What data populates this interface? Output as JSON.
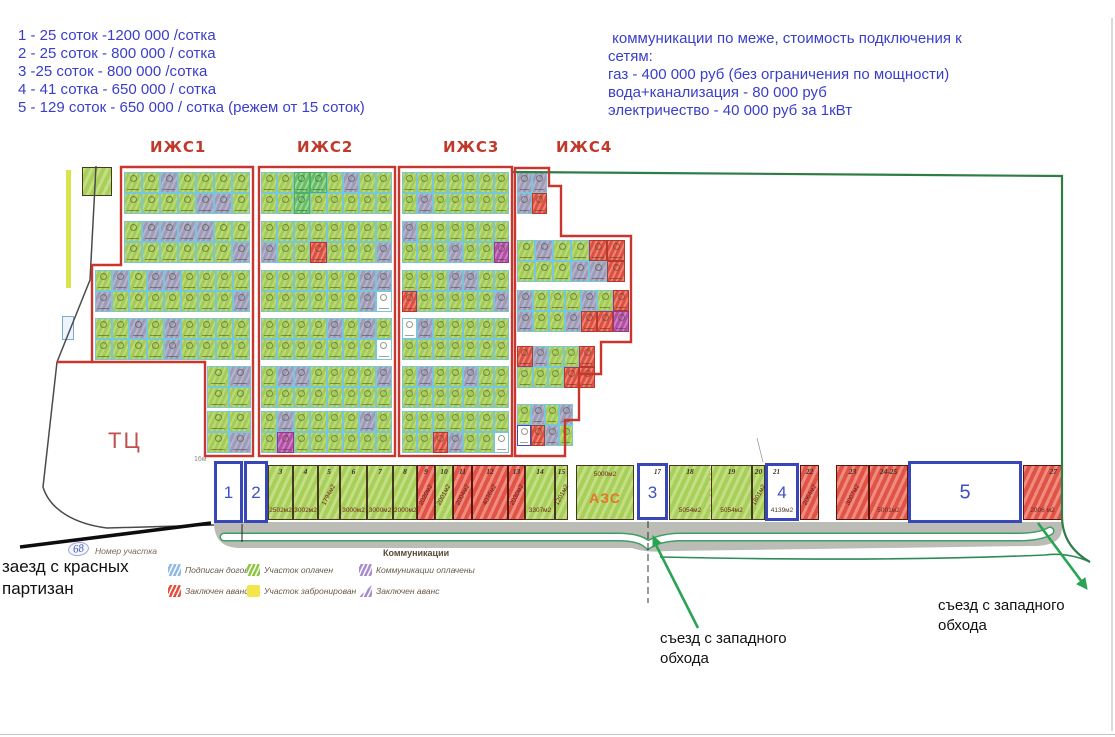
{
  "pricing": {
    "lines": [
      "1 - 25 соток -1200 000 /сотка",
      "2 - 25 соток - 800 000 / сотка",
      "3 -25 соток - 800 000 /сотка",
      "4 - 41 сотка - 650 000 / сотка",
      "5 - 129 соток - 650 000 / сотка (режем от 15 соток)"
    ]
  },
  "utilities": {
    "lines": [
      " коммуникации по меже, стоимость подключения к",
      "сетям:",
      "газ - 400 000 руб (без ограничения по мощности)",
      "вода+канализация - 80 000 руб",
      "электричество - 40 000 руб за 1кВт"
    ]
  },
  "annotations": {
    "entrance": "заезд с красных партизан",
    "exit_left": "съезд с западного обхода",
    "exit_right": "съезд с западного обхода"
  },
  "plot_number_key": {
    "number": "68",
    "label": "Номер участка"
  },
  "legend": {
    "title": "Коммуникации",
    "items": [
      {
        "label": "Подписан договор",
        "swatch": "blue-hatch",
        "x": 168,
        "y": 564
      },
      {
        "label": "Заключен аванс",
        "swatch": "red-hatch",
        "x": 168,
        "y": 585
      },
      {
        "label": "Участок оплачен",
        "swatch": "green-hatch",
        "x": 247,
        "y": 564
      },
      {
        "label": "Участок забронирован",
        "swatch": "yellow",
        "x": 247,
        "y": 585
      },
      {
        "label": "Коммуникации оплачены",
        "swatch": "purple-hatch",
        "x": 359,
        "y": 564
      },
      {
        "label": "Заключен аванс",
        "swatch": "purple-triangle",
        "x": 359,
        "y": 585
      }
    ]
  },
  "map": {
    "tc_label": "ТЦ",
    "scale_note": "16м",
    "zone_labels": [
      {
        "text": "ИЖС1",
        "x": 150,
        "y": 138
      },
      {
        "text": "ИЖС2",
        "x": 297,
        "y": 138
      },
      {
        "text": "ИЖС3",
        "x": 443,
        "y": 138
      },
      {
        "text": "ИЖС4",
        "x": 556,
        "y": 138
      }
    ],
    "zones": [
      {
        "name": "izhs1",
        "strips": [
          {
            "x": 124,
            "y": 172,
            "w": 126,
            "rows": [
              "ggygggg",
              "ggggyyg"
            ]
          },
          {
            "x": 124,
            "y": 221,
            "w": 126,
            "rows": [
              "gyyyygg",
              "ggggggy"
            ]
          },
          {
            "x": 95,
            "y": 270,
            "w": 155,
            "rows": [
              "gygyygggg",
              "ygggggggy"
            ]
          },
          {
            "x": 95,
            "y": 318,
            "w": 155,
            "rows": [
              "ggygygggg",
              "ggggygggg"
            ]
          },
          {
            "x": 207,
            "y": 366,
            "w": 44,
            "rows": [
              "gy",
              "gg"
            ]
          },
          {
            "x": 207,
            "y": 411,
            "w": 44,
            "rows": [
              "gg",
              "gy"
            ]
          }
        ]
      },
      {
        "name": "izhs2",
        "strips": [
          {
            "x": 261,
            "y": 172,
            "w": 131,
            "rows": [
              "ggGGgygg",
              "ggGggggg"
            ]
          },
          {
            "x": 261,
            "y": 221,
            "w": 131,
            "rows": [
              "gggggggg",
              "yggrgggy"
            ]
          },
          {
            "x": 261,
            "y": 270,
            "w": 131,
            "rows": [
              "ggggggyy",
              "ggggggyw"
            ]
          },
          {
            "x": 261,
            "y": 318,
            "w": 131,
            "rows": [
              "ggggygyg",
              "gggggggw"
            ]
          },
          {
            "x": 261,
            "y": 366,
            "w": 131,
            "rows": [
              "gyyggggy",
              "gggggggg"
            ]
          },
          {
            "x": 261,
            "y": 411,
            "w": 131,
            "rows": [
              "gyggggyg",
              "gmgggggg"
            ]
          }
        ]
      },
      {
        "name": "izhs3",
        "strips": [
          {
            "x": 402,
            "y": 172,
            "w": 107,
            "rows": [
              "ggggggg",
              "gyggggg"
            ]
          },
          {
            "x": 402,
            "y": 221,
            "w": 107,
            "rows": [
              "ygggggg",
              "gggyggm"
            ]
          },
          {
            "x": 402,
            "y": 270,
            "w": 107,
            "rows": [
              "gggyygg",
              "rgggggy"
            ]
          },
          {
            "x": 402,
            "y": 318,
            "w": 107,
            "rows": [
              "wyggggg",
              "ggggggg"
            ]
          },
          {
            "x": 402,
            "y": 366,
            "w": 107,
            "rows": [
              "gyggygg",
              "ggggggg"
            ]
          },
          {
            "x": 402,
            "y": 411,
            "w": 107,
            "rows": [
              "ggggggg",
              "ggryggw"
            ]
          }
        ]
      },
      {
        "name": "izhs4",
        "strips": [
          {
            "x": 517,
            "y": 172,
            "w": 30,
            "rows": [
              "yy",
              "yr"
            ]
          },
          {
            "x": 517,
            "y": 240,
            "w": 108,
            "rows": [
              "gyggrr",
              "gggyyr"
            ]
          },
          {
            "x": 517,
            "y": 290,
            "w": 112,
            "rows": [
              "ygggygr",
              "yggyrrm"
            ]
          },
          {
            "x": 517,
            "y": 346,
            "w": 78,
            "rows": [
              "ryggr",
              "gggrr"
            ]
          },
          {
            "x": 517,
            "y": 404,
            "w": 56,
            "rows": [
              "gygy",
              "bryg"
            ]
          }
        ]
      }
    ],
    "bottom_plots": [
      {
        "n": "3",
        "area": "2502м2",
        "c": "green",
        "x": 268,
        "w": 25
      },
      {
        "n": "4",
        "area": "3002м2",
        "c": "green",
        "x": 293,
        "w": 25
      },
      {
        "n": "5",
        "area": "1794м2",
        "c": "green",
        "x": 318,
        "w": 22,
        "diag": true
      },
      {
        "n": "6",
        "area": "3000м2",
        "c": "green",
        "x": 340,
        "w": 27
      },
      {
        "n": "7",
        "area": "3000м2",
        "c": "green",
        "x": 367,
        "w": 26
      },
      {
        "n": "8",
        "area": "2000м2",
        "c": "green",
        "x": 393,
        "w": 24
      },
      {
        "n": "9",
        "area": "2020м2",
        "c": "red",
        "x": 417,
        "w": 18,
        "diag": true
      },
      {
        "n": "10",
        "area": "2001м2",
        "c": "green",
        "x": 435,
        "w": 18,
        "diag": true
      },
      {
        "n": "11",
        "area": "2004м2",
        "c": "red",
        "x": 453,
        "w": 19,
        "diag": true
      },
      {
        "n": "12",
        "area": "4036м2",
        "c": "red",
        "x": 472,
        "w": 36,
        "diag": true
      },
      {
        "n": "13",
        "area": "2030м2",
        "c": "red",
        "x": 508,
        "w": 17,
        "diag": true
      },
      {
        "n": "14",
        "area": "3307м2",
        "c": "green",
        "x": 525,
        "w": 30
      },
      {
        "n": "15",
        "area": "1201м2",
        "c": "green",
        "x": 555,
        "w": 13,
        "diag": true
      },
      {
        "n": "",
        "area": "5000м2",
        "c": "green",
        "x": 576,
        "w": 58,
        "azs": true,
        "azs_label": "АЗС"
      },
      {
        "n": "18",
        "area": "5054м2",
        "c": "green",
        "x": 669,
        "w": 42,
        "dashRight": true
      },
      {
        "n": "19",
        "area": "5054м2",
        "c": "green",
        "x": 711,
        "w": 41
      },
      {
        "n": "20",
        "area": "1801м2",
        "c": "green",
        "x": 752,
        "w": 13,
        "diag": true
      },
      {
        "n": "22",
        "area": "2064м2",
        "c": "red",
        "x": 800,
        "w": 19,
        "diag": true
      },
      {
        "n": "23",
        "area": "3007м2",
        "c": "red",
        "x": 836,
        "w": 33,
        "diag": true
      },
      {
        "n": "24-25",
        "area": "5001м2",
        "c": "red",
        "x": 869,
        "w": 39
      },
      {
        "n": "27",
        "area": "2006 м2",
        "c": "red",
        "x": 1023,
        "w": 39,
        "numpos": "r"
      }
    ],
    "boxes": [
      {
        "label": "1",
        "x": 214,
        "y": 461,
        "w": 29,
        "h": 62
      },
      {
        "label": "2",
        "x": 244,
        "y": 461,
        "w": 24,
        "h": 62
      },
      {
        "label": "3",
        "x": 637,
        "y": 463,
        "w": 31,
        "h": 57,
        "plot": "17",
        "plotpos": "tr"
      },
      {
        "label": "4",
        "x": 765,
        "y": 463,
        "w": 34,
        "h": 58,
        "plot": "21",
        "plotpos": "tl",
        "area": "4139м2"
      },
      {
        "label": "5",
        "x": 908,
        "y": 461,
        "w": 114,
        "h": 62,
        "big": true
      }
    ]
  },
  "colors": {
    "info_text_blue": "#3a3ec8",
    "box_outline_blue": "#3847b8",
    "zone_border_red": "#c8372d",
    "site_boundary_green": "#2e7d45",
    "arrow_green": "#2aa352",
    "road_gray": "#b6b6b0",
    "plot_green": "#a8cf59",
    "plot_red": "#e05446",
    "reserved_yellow": "#f4e54a",
    "communications_purple": "#a98ccd"
  }
}
